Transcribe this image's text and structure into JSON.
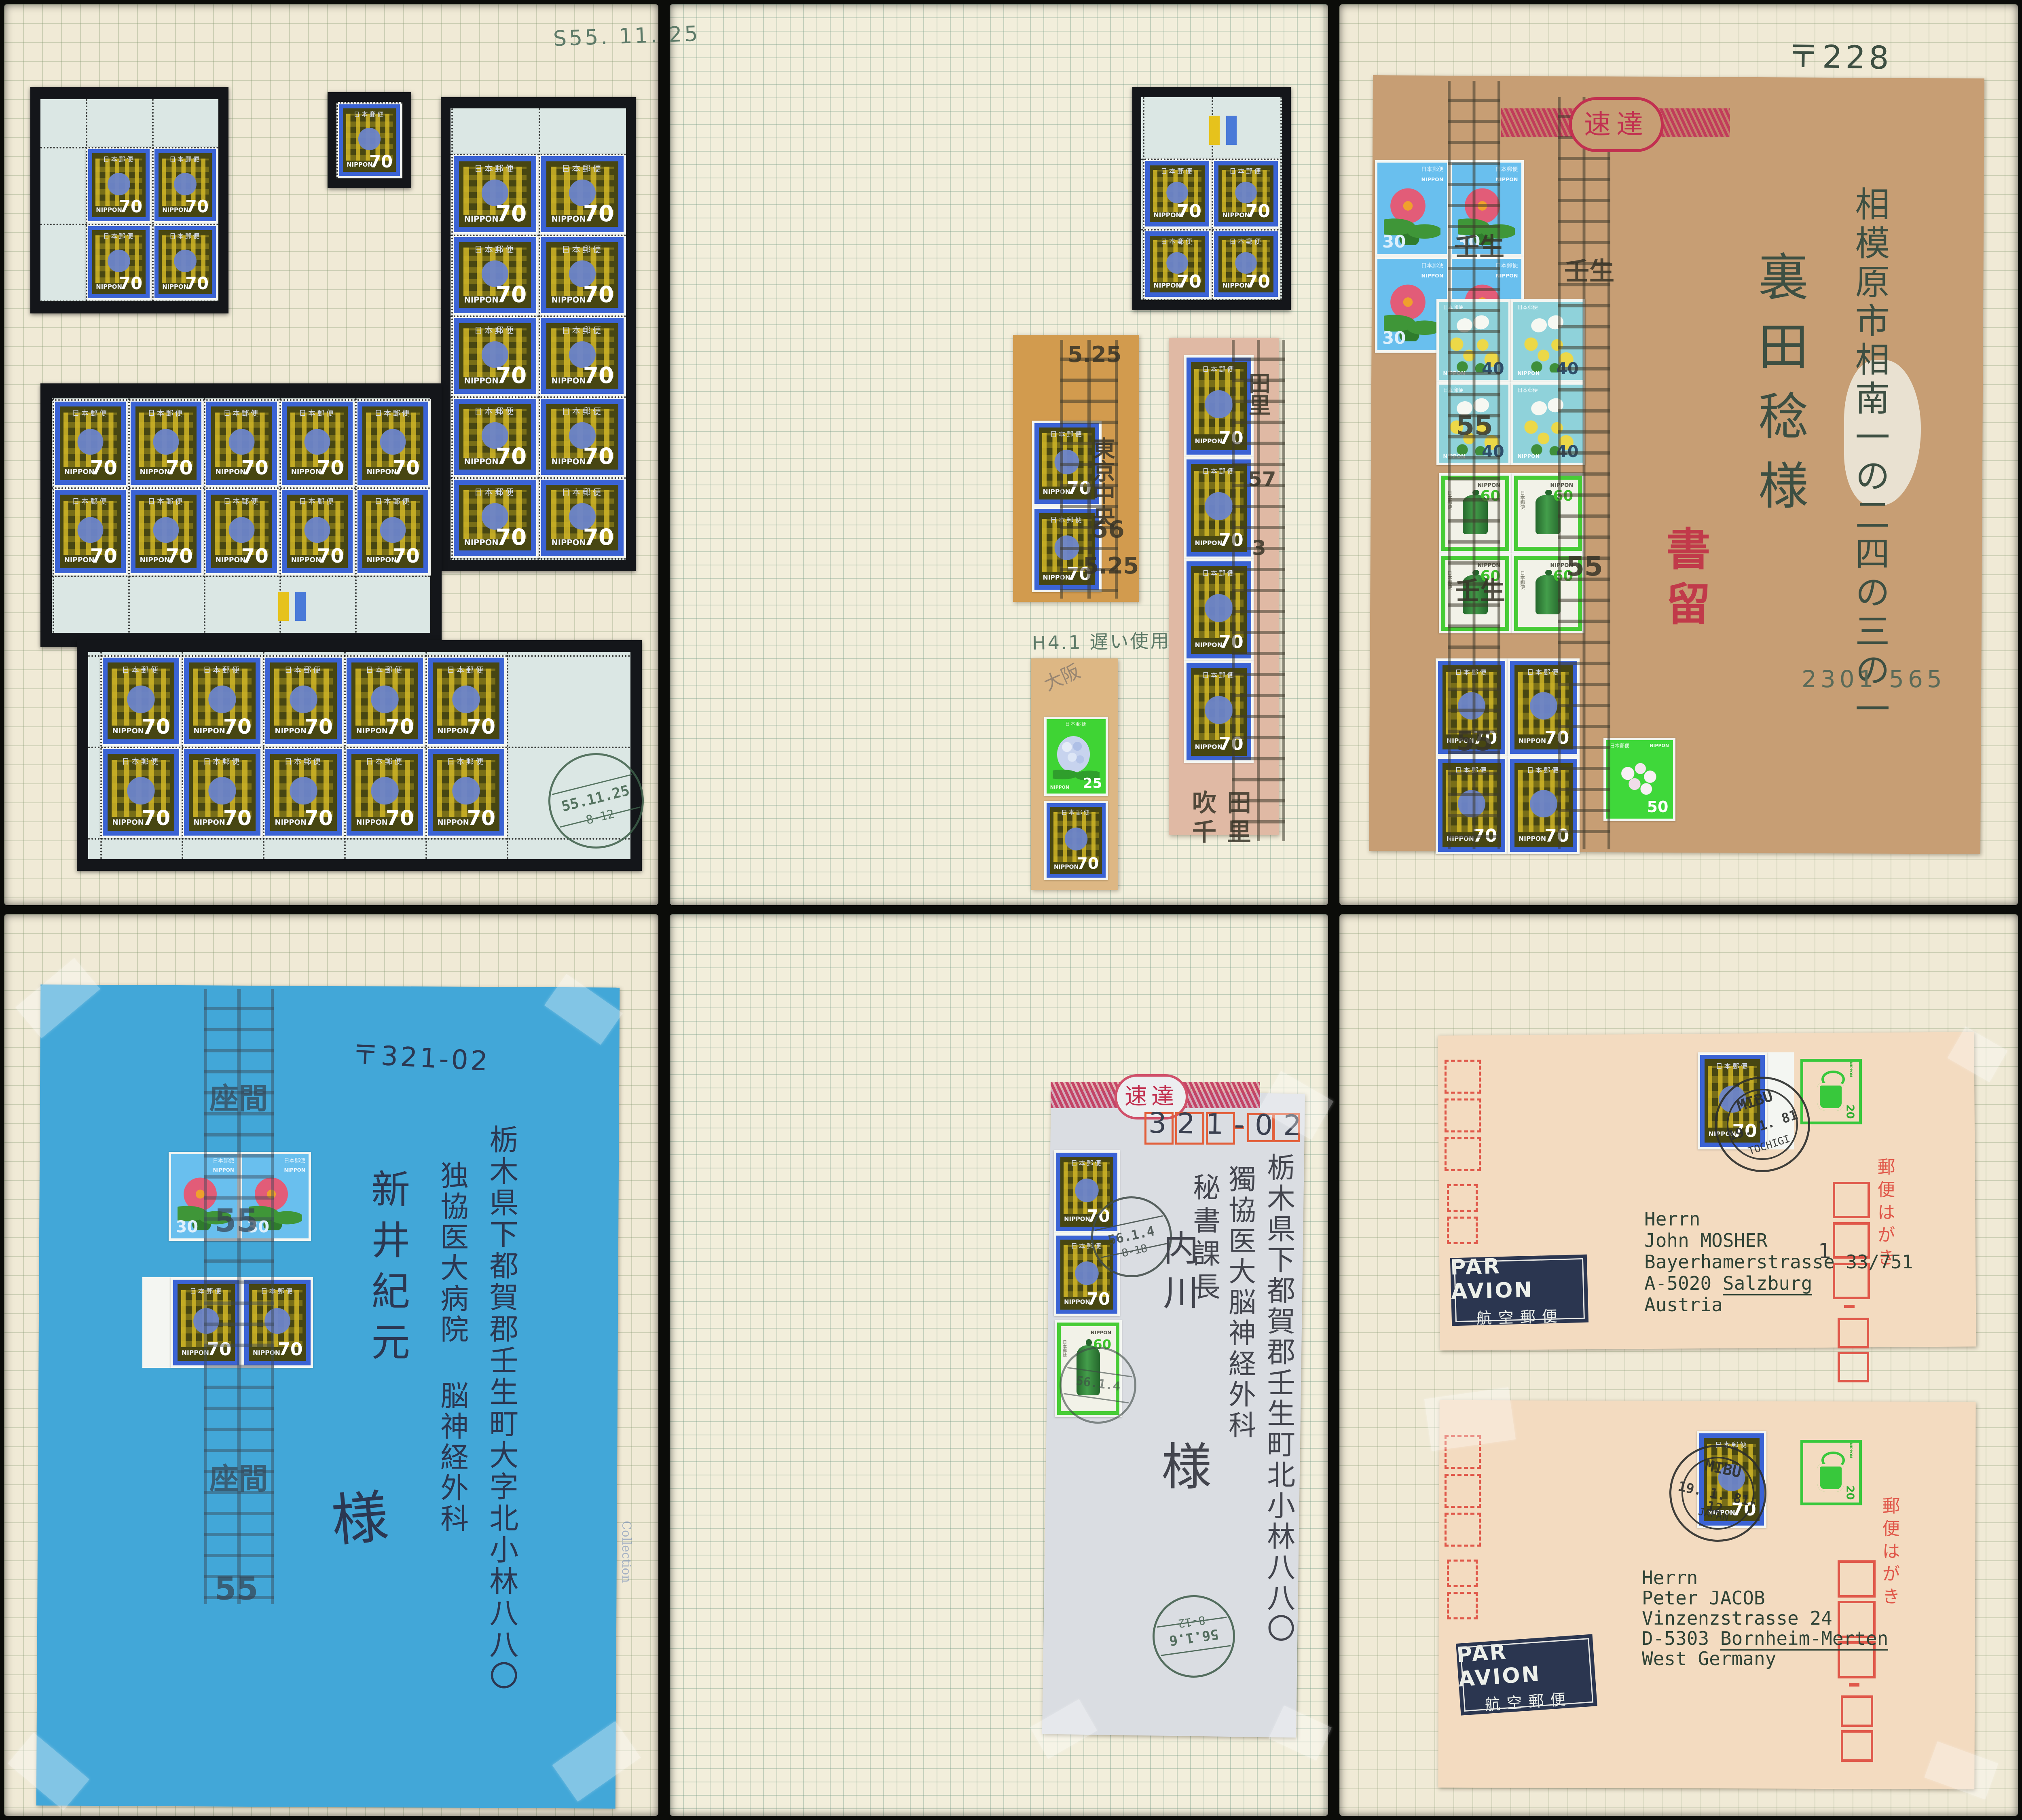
{
  "title": "Japanese definitive stamps album spread – six pages",
  "stamps": {
    "s70": {
      "top": "日本郵便",
      "country": "NIPPON",
      "value": "70"
    },
    "s30": {
      "top": "日本郵便",
      "country": "NIPPON",
      "value": "30"
    },
    "s40": {
      "top": "日本郵便",
      "country": "NIPPON",
      "value": "40"
    },
    "s60": {
      "top": "日本郵便",
      "country": "NIPPON",
      "value": "60"
    },
    "s25": {
      "top": "日本郵便",
      "country": "NIPPON",
      "value": "25"
    },
    "s50": {
      "top": "日本郵便",
      "country": "NIPPON",
      "value": "50"
    },
    "ind20": {
      "country": "NIPPON",
      "value": "20"
    }
  },
  "page1": {
    "date_note": "S55. 11. 25",
    "postmark": {
      "date": "55.11.25",
      "time": "8-12"
    }
  },
  "page2": {
    "cancel_tokyo": {
      "time": "5.25",
      "place": "東京中央",
      "year": "56",
      "date": "5.25"
    },
    "cancel_suita": {
      "col": "田里",
      "num1": "57",
      "num2": "3",
      "place1": "吹田",
      "place2": "千里"
    },
    "late_use_note": "H4.1 遅い使用",
    "pencil_note": "大阪"
  },
  "page3": {
    "express": "速達",
    "postal_code": "〒228",
    "address": "相模原市相南一の二四の三の一",
    "addressee": "裏田稔様",
    "registered": "書留",
    "code_number": "2301 565",
    "cancel": {
      "place": "壬生",
      "num": "55"
    }
  },
  "page4": {
    "postal_code": "〒321-02",
    "address1": "栃木県下都賀郡壬生町大字北小林八八〇",
    "address2": "独協医大病院 脳神経外科",
    "addressee": "新井紀元",
    "honorific": "様",
    "cancel": {
      "place": "座間",
      "num": "55"
    },
    "edge_text": "Collection"
  },
  "page5": {
    "express": "速達",
    "code_digits": "321-02",
    "address1": "栃木県下都賀郡壬生町北小林八八〇",
    "address2": "獨協医大脳神経外科",
    "address3": "秘書課長",
    "addressee": "内川",
    "honorific": "様",
    "postmark_top": {
      "date": "56.1.4",
      "time": "8-18"
    },
    "postmark_bottom": {
      "date": "56.1.6",
      "time": "8-12"
    }
  },
  "page6": {
    "airmail_label": {
      "line1": "PAR AVION",
      "line2": "航空郵便"
    },
    "hagaki": "郵便はがき",
    "handwritten_one": "1",
    "card1": {
      "postmark": {
        "top": "MIBU",
        "date": "19. 1. 81",
        "bottom": "TOCHIGI"
      },
      "addr1": "Herrn",
      "addr2": "John MOSHER",
      "addr3": "Bayerhamerstrasse 33/751",
      "addr4_prefix": "A-5020 ",
      "addr4_city": "Salzburg",
      "addr5": "Austria"
    },
    "card2": {
      "postmark": {
        "top": "MIBU",
        "date": "19. 1. 81-12",
        "bottom": "JAPAN"
      },
      "addr1": "Herrn",
      "addr2": "Peter JACOB",
      "addr3": "Vinzenzstrasse 24",
      "addr4_prefix": "D-5303 ",
      "addr4_city": "Bornheim-Merten",
      "addr5": "West Germany"
    }
  }
}
